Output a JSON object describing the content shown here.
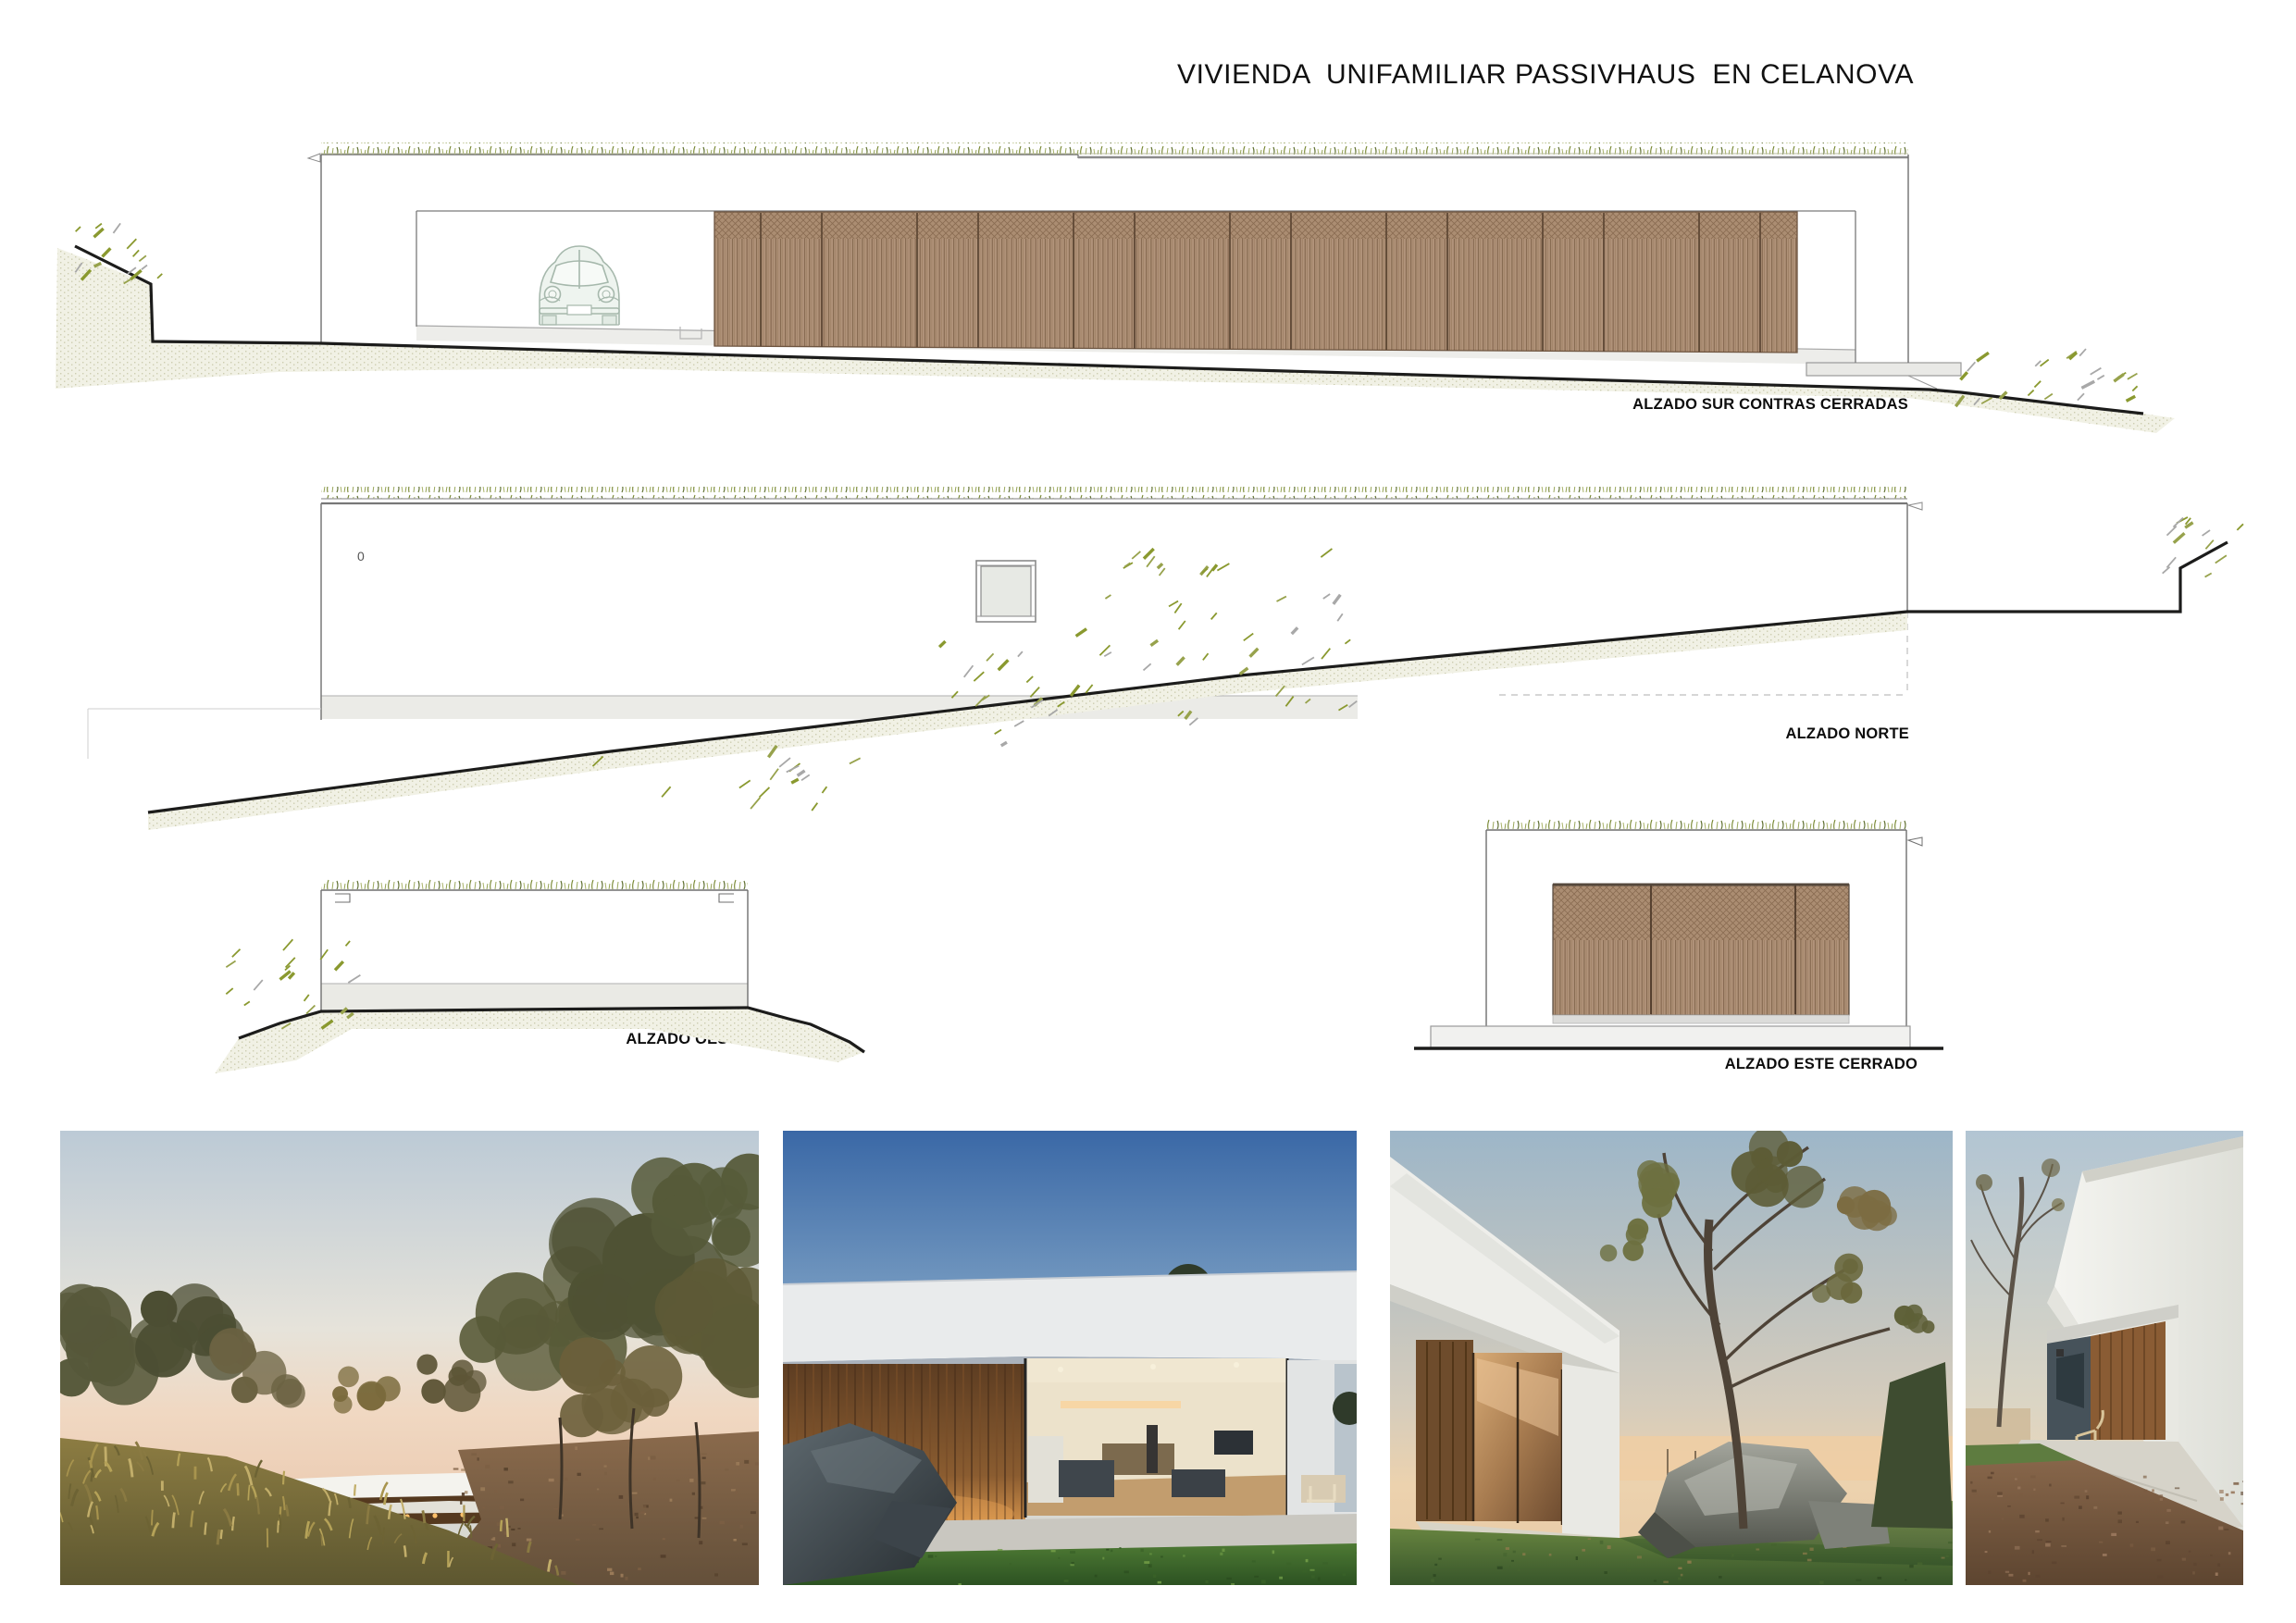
{
  "title": "VIVIENDA  UNIFAMILIAR PASSIVHAUS  EN CELANOVA",
  "elevations": {
    "sur": {
      "label": "ALZADO SUR CONTRAS CERRADAS"
    },
    "norte": {
      "label": "ALZADO NORTE",
      "level_mark": "0"
    },
    "oeste": {
      "label": "ALZADO OESTE"
    },
    "este": {
      "label": "ALZADO ESTE CERRADO"
    }
  },
  "photos": [
    {
      "name": "dusk-hillside-ferns",
      "description": "house on hillside at dusk with autumn ferns, trees and driveway"
    },
    {
      "name": "twilight-living-room",
      "description": "twilight view of timber wall and glazed living room lit from inside"
    },
    {
      "name": "tree-and-boulder",
      "description": "white volume with timber glazing beside large boulder and bare tree"
    },
    {
      "name": "timber-recess",
      "description": "perspective of white volume with timber-lined recess and terrace"
    }
  ],
  "colors": {
    "wood_slats": "#b1937a",
    "wood_slat_line": "#7c5f46",
    "roof_grass": "#7b8b3a",
    "terrain_hatch": "#f1f1e5",
    "terrain_dot": "#cdcdb0",
    "ground_line": "#1c1c1b",
    "drawing_line": "#6f6f6f",
    "plinth": "#eaeae5",
    "car_outline": "#a6b8ac"
  }
}
